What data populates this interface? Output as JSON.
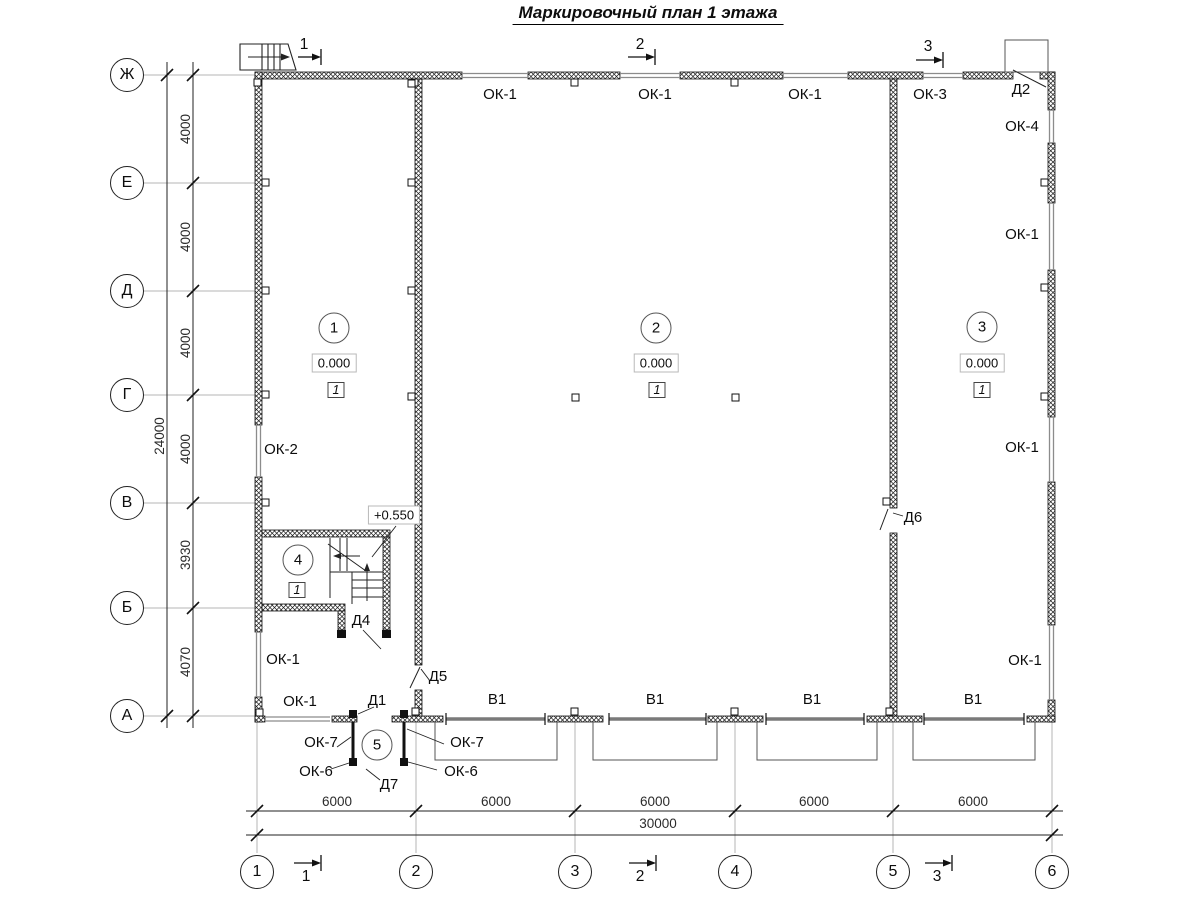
{
  "title": "Маркировочный план 1 этажа",
  "colors": {
    "wall_hatch": "#1a1a1a",
    "window_line": "#8c8c8c",
    "gate_line": "#7a7a7a",
    "axis_line": "#b5b5b5"
  },
  "drawing": {
    "axis_rows": [
      {
        "label": "Ж",
        "y": 75
      },
      {
        "label": "Е",
        "y": 183
      },
      {
        "label": "Д",
        "y": 291
      },
      {
        "label": "Г",
        "y": 395
      },
      {
        "label": "В",
        "y": 503
      },
      {
        "label": "Б",
        "y": 608
      },
      {
        "label": "А",
        "y": 716
      }
    ],
    "axis_cols": [
      {
        "label": "1",
        "x": 257
      },
      {
        "label": "2",
        "x": 416
      },
      {
        "label": "3",
        "x": 575
      },
      {
        "label": "4",
        "x": 735
      },
      {
        "label": "5",
        "x": 893
      },
      {
        "label": "6",
        "x": 1052
      }
    ],
    "row_dims": [
      {
        "text": "4000",
        "y": 129
      },
      {
        "text": "4000",
        "y": 237
      },
      {
        "text": "4000",
        "y": 343
      },
      {
        "text": "4000",
        "y": 449
      },
      {
        "text": "3930",
        "y": 555
      },
      {
        "text": "4070",
        "y": 662
      }
    ],
    "row_total_dim": {
      "text": "24000",
      "x": 160,
      "y": 436
    },
    "col_dims": [
      {
        "text": "6000",
        "x": 337
      },
      {
        "text": "6000",
        "x": 496
      },
      {
        "text": "6000",
        "x": 655
      },
      {
        "text": "6000",
        "x": 814
      },
      {
        "text": "6000",
        "x": 973
      }
    ],
    "col_total_dim": {
      "text": "30000",
      "x": 658,
      "y": 824
    },
    "opening_marks": [
      {
        "text": "ОК-1",
        "x": 500,
        "y": 95
      },
      {
        "text": "ОК-1",
        "x": 655,
        "y": 95
      },
      {
        "text": "ОК-1",
        "x": 805,
        "y": 95
      },
      {
        "text": "ОК-3",
        "x": 930,
        "y": 95
      },
      {
        "text": "Д2",
        "x": 1021,
        "y": 90
      },
      {
        "text": "ОК-4",
        "x": 1022,
        "y": 127
      },
      {
        "text": "ОК-1",
        "x": 1022,
        "y": 235
      },
      {
        "text": "ОК-1",
        "x": 1022,
        "y": 448
      },
      {
        "text": "ОК-1",
        "x": 1025,
        "y": 661
      },
      {
        "text": "ОК-2",
        "x": 281,
        "y": 450
      },
      {
        "text": "ОК-1",
        "x": 283,
        "y": 660
      },
      {
        "text": "ОК-1",
        "x": 300,
        "y": 702
      },
      {
        "text": "Д1",
        "x": 377,
        "y": 701
      },
      {
        "text": "В1",
        "x": 497,
        "y": 700
      },
      {
        "text": "В1",
        "x": 655,
        "y": 700
      },
      {
        "text": "В1",
        "x": 812,
        "y": 700
      },
      {
        "text": "В1",
        "x": 973,
        "y": 700
      },
      {
        "text": "Д5",
        "x": 438,
        "y": 677
      },
      {
        "text": "Д4",
        "x": 361,
        "y": 621
      },
      {
        "text": "Д6",
        "x": 913,
        "y": 518
      },
      {
        "text": "Д7",
        "x": 389,
        "y": 785
      },
      {
        "text": "ОК-7",
        "x": 321,
        "y": 743
      },
      {
        "text": "ОК-6",
        "x": 316,
        "y": 772
      },
      {
        "text": "ОК-7",
        "x": 467,
        "y": 743
      },
      {
        "text": "ОК-6",
        "x": 461,
        "y": 772
      }
    ],
    "rooms": [
      {
        "number": "1",
        "elevation": "0.000",
        "floor_type": "1",
        "cx": 334,
        "cy": 328,
        "ex": 334,
        "ey": 363,
        "fx": 336,
        "fy": 390
      },
      {
        "number": "2",
        "elevation": "0.000",
        "floor_type": "1",
        "cx": 656,
        "cy": 328,
        "ex": 656,
        "ey": 363,
        "fx": 657,
        "fy": 390
      },
      {
        "number": "3",
        "elevation": "0.000",
        "floor_type": "1",
        "cx": 982,
        "cy": 327,
        "ex": 982,
        "ey": 363,
        "fx": 982,
        "fy": 390
      },
      {
        "number": "4",
        "floor_type": "1",
        "cx": 298,
        "cy": 560,
        "fx": 297,
        "fy": 590
      },
      {
        "number": "5",
        "cx": 377,
        "cy": 745
      }
    ],
    "stair_elevation": {
      "text": "+0.550",
      "x": 394,
      "y": 515
    },
    "section_marks": [
      {
        "label": "1",
        "x": 304,
        "y": 45
      },
      {
        "label": "2",
        "x": 640,
        "y": 45
      },
      {
        "label": "3",
        "x": 928,
        "y": 47
      },
      {
        "label": "1",
        "x": 306,
        "y": 877
      },
      {
        "label": "2",
        "x": 640,
        "y": 877
      },
      {
        "label": "3",
        "x": 937,
        "y": 877
      }
    ]
  }
}
